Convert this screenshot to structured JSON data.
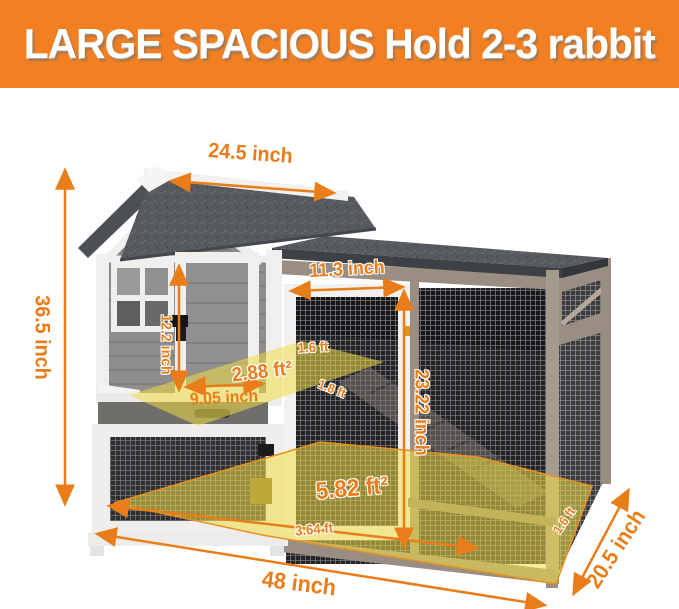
{
  "banner": {
    "title": "LARGE SPACIOUS Hold 2-3 rabbit"
  },
  "colors": {
    "banner_bg": "#f28022",
    "annotation_orange": "#e87d1a",
    "floor_highlight_yellow": "rgba(240,221,70,0.55)",
    "roof_gray": "#565a5e",
    "frame_taupe": "#9a8e82",
    "trim_white": "#f2f1ef"
  },
  "dimensions": {
    "roof_width": "24.5 inch",
    "total_height": "36.5 inch",
    "run_door_width": "11.3 inch",
    "house_door_height": "12.2 inch",
    "upper_floor_area": "2.88 ft²",
    "upper_floor_depth": "9.05 inch",
    "upper_floor_width": "1.6 ft",
    "upper_floor_length": "1.8 ft",
    "run_door_height": "23.22 inch",
    "lower_floor_area": "5.82 ft²",
    "lower_floor_length": "3.64 ft",
    "lower_floor_width": "1.6 ft",
    "total_width": "48 inch",
    "total_depth": "20.5 inch"
  }
}
